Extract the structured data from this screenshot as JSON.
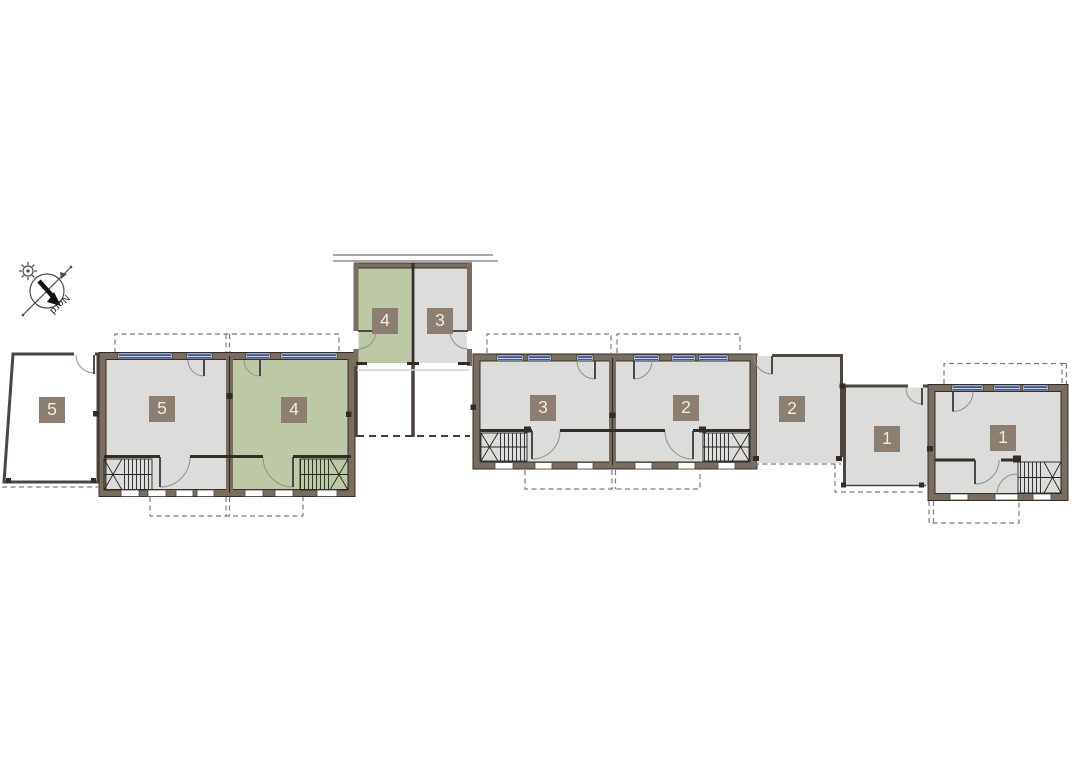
{
  "compass": {
    "label": "Nord"
  },
  "colors": {
    "floor_gray": "#dcdddb",
    "floor_green": "#bdc9a5",
    "wall_brown": "#796d60",
    "wall_edge": "#332d27",
    "label_bg": "#8c7e70",
    "label_text": "#f4ecd9",
    "window_blue": "#3a57a7",
    "dash_gray": "#7c7c7c"
  },
  "units": [
    {
      "id": "unit-5-annex",
      "number": "5",
      "highlighted": false
    },
    {
      "id": "unit-5",
      "number": "5",
      "highlighted": false
    },
    {
      "id": "unit-4",
      "number": "4",
      "highlighted": true
    },
    {
      "id": "unit-4-garden-house",
      "number": "4",
      "highlighted": true
    },
    {
      "id": "unit-3-garden-house",
      "number": "3",
      "highlighted": false
    },
    {
      "id": "unit-3",
      "number": "3",
      "highlighted": false
    },
    {
      "id": "unit-2",
      "number": "2",
      "highlighted": false
    },
    {
      "id": "unit-2-annex",
      "number": "2",
      "highlighted": false
    },
    {
      "id": "unit-1-annex",
      "number": "1",
      "highlighted": false
    },
    {
      "id": "unit-1",
      "number": "1",
      "highlighted": false
    }
  ]
}
